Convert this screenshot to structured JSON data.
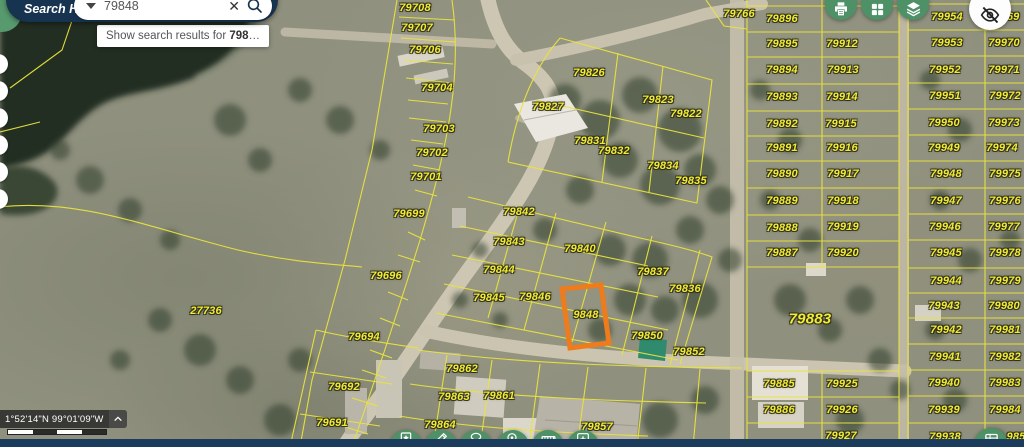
{
  "search": {
    "label": "Search Here:",
    "value": "79848",
    "tooltip_prefix": "Show search results for ",
    "tooltip_query": "798",
    "tooltip_suffix": "…"
  },
  "status": {
    "coordinates": "1°52'14\"N 99°01'09\"W"
  },
  "icons": {
    "clear_glyph": "✕",
    "top_toolbar": [
      "print-icon",
      "apps-grid-icon",
      "layers-icon",
      "visibility-off-icon"
    ],
    "bottom_toolbar": [
      "bookmark-star-icon",
      "pencil-icon",
      "lasso-tool-icon",
      "search-location-icon",
      "measure-icon",
      "add-icon"
    ],
    "bottom_right": "attribute-table-icon"
  },
  "colors": {
    "accent_green": "#4f9166",
    "navy": "#16334f",
    "parcel_line": "#e9e43c",
    "label_yellow": "#f2ec33",
    "selection_orange": "#ee7b1c"
  },
  "map": {
    "selected_parcel_label": "9848",
    "parcels": [
      {
        "t": "79708",
        "x": 415,
        "y": 8
      },
      {
        "t": "79707",
        "x": 417,
        "y": 28
      },
      {
        "t": "79706",
        "x": 425,
        "y": 50
      },
      {
        "t": "79704",
        "x": 437,
        "y": 88
      },
      {
        "t": "79703",
        "x": 439,
        "y": 129
      },
      {
        "t": "79702",
        "x": 432,
        "y": 153
      },
      {
        "t": "79701",
        "x": 426,
        "y": 177
      },
      {
        "t": "79699",
        "x": 409,
        "y": 214
      },
      {
        "t": "79696",
        "x": 386,
        "y": 276
      },
      {
        "t": "27736",
        "x": 206,
        "y": 311
      },
      {
        "t": "79694",
        "x": 364,
        "y": 337
      },
      {
        "t": "79692",
        "x": 344,
        "y": 387
      },
      {
        "t": "79691",
        "x": 332,
        "y": 423
      },
      {
        "t": "79826",
        "x": 589,
        "y": 73
      },
      {
        "t": "79827",
        "x": 548,
        "y": 107
      },
      {
        "t": "79823",
        "x": 658,
        "y": 100
      },
      {
        "t": "79822",
        "x": 686,
        "y": 114
      },
      {
        "t": "79831",
        "x": 590,
        "y": 141
      },
      {
        "t": "79832",
        "x": 614,
        "y": 151
      },
      {
        "t": "79834",
        "x": 663,
        "y": 166
      },
      {
        "t": "79835",
        "x": 691,
        "y": 181
      },
      {
        "t": "79842",
        "x": 519,
        "y": 212
      },
      {
        "t": "79843",
        "x": 509,
        "y": 242
      },
      {
        "t": "79844",
        "x": 499,
        "y": 270
      },
      {
        "t": "79845",
        "x": 489,
        "y": 298
      },
      {
        "t": "79846",
        "x": 535,
        "y": 297
      },
      {
        "t": "79840",
        "x": 580,
        "y": 249
      },
      {
        "t": "79837",
        "x": 653,
        "y": 272
      },
      {
        "t": "79836",
        "x": 685,
        "y": 289
      },
      {
        "t": "9848",
        "x": 586,
        "y": 315
      },
      {
        "t": "79850",
        "x": 647,
        "y": 336
      },
      {
        "t": "79852",
        "x": 689,
        "y": 352
      },
      {
        "t": "79862",
        "x": 462,
        "y": 369
      },
      {
        "t": "79863",
        "x": 454,
        "y": 397
      },
      {
        "t": "79861",
        "x": 499,
        "y": 396
      },
      {
        "t": "79864",
        "x": 440,
        "y": 425
      },
      {
        "t": "79857",
        "x": 597,
        "y": 427
      },
      {
        "t": "79766",
        "x": 739,
        "y": 14
      },
      {
        "t": "79896",
        "x": 782,
        "y": 19
      },
      {
        "t": "79895",
        "x": 782,
        "y": 44
      },
      {
        "t": "79894",
        "x": 782,
        "y": 70
      },
      {
        "t": "79893",
        "x": 782,
        "y": 97
      },
      {
        "t": "79892",
        "x": 782,
        "y": 124
      },
      {
        "t": "79891",
        "x": 782,
        "y": 148
      },
      {
        "t": "79890",
        "x": 782,
        "y": 174
      },
      {
        "t": "79889",
        "x": 782,
        "y": 201
      },
      {
        "t": "79888",
        "x": 782,
        "y": 228
      },
      {
        "t": "79887",
        "x": 782,
        "y": 253
      },
      {
        "t": "79883",
        "x": 810,
        "y": 319,
        "big": true
      },
      {
        "t": "79885",
        "x": 779,
        "y": 384
      },
      {
        "t": "79886",
        "x": 779,
        "y": 410
      },
      {
        "t": "79912",
        "x": 842,
        "y": 44
      },
      {
        "t": "79913",
        "x": 843,
        "y": 70
      },
      {
        "t": "79914",
        "x": 842,
        "y": 97
      },
      {
        "t": "79915",
        "x": 841,
        "y": 124
      },
      {
        "t": "79916",
        "x": 842,
        "y": 148
      },
      {
        "t": "79917",
        "x": 843,
        "y": 174
      },
      {
        "t": "79918",
        "x": 843,
        "y": 201
      },
      {
        "t": "79919",
        "x": 843,
        "y": 227
      },
      {
        "t": "79920",
        "x": 843,
        "y": 253
      },
      {
        "t": "79925",
        "x": 842,
        "y": 384
      },
      {
        "t": "79926",
        "x": 842,
        "y": 410
      },
      {
        "t": "79927",
        "x": 841,
        "y": 436
      },
      {
        "t": "79954",
        "x": 947,
        "y": 17
      },
      {
        "t": "79953",
        "x": 947,
        "y": 43
      },
      {
        "t": "79952",
        "x": 945,
        "y": 70
      },
      {
        "t": "79951",
        "x": 945,
        "y": 96
      },
      {
        "t": "79950",
        "x": 944,
        "y": 123
      },
      {
        "t": "79949",
        "x": 944,
        "y": 148
      },
      {
        "t": "79948",
        "x": 946,
        "y": 174
      },
      {
        "t": "79947",
        "x": 946,
        "y": 201
      },
      {
        "t": "79946",
        "x": 945,
        "y": 227
      },
      {
        "t": "79945",
        "x": 946,
        "y": 253
      },
      {
        "t": "79944",
        "x": 946,
        "y": 281
      },
      {
        "t": "79943",
        "x": 944,
        "y": 306
      },
      {
        "t": "79942",
        "x": 946,
        "y": 330
      },
      {
        "t": "79941",
        "x": 945,
        "y": 357
      },
      {
        "t": "79940",
        "x": 944,
        "y": 383
      },
      {
        "t": "79939",
        "x": 944,
        "y": 410
      },
      {
        "t": "79938",
        "x": 945,
        "y": 437
      },
      {
        "t": "969",
        "x": 1010,
        "y": 17
      },
      {
        "t": "79970",
        "x": 1004,
        "y": 43
      },
      {
        "t": "79971",
        "x": 1004,
        "y": 70
      },
      {
        "t": "79972",
        "x": 1005,
        "y": 96
      },
      {
        "t": "79973",
        "x": 1004,
        "y": 123
      },
      {
        "t": "79974",
        "x": 1002,
        "y": 148
      },
      {
        "t": "79975",
        "x": 1005,
        "y": 174
      },
      {
        "t": "79976",
        "x": 1005,
        "y": 201
      },
      {
        "t": "79977",
        "x": 1004,
        "y": 227
      },
      {
        "t": "79978",
        "x": 1005,
        "y": 253
      },
      {
        "t": "79979",
        "x": 1005,
        "y": 281
      },
      {
        "t": "79980",
        "x": 1004,
        "y": 306
      },
      {
        "t": "79981",
        "x": 1005,
        "y": 330
      },
      {
        "t": "79982",
        "x": 1005,
        "y": 357
      },
      {
        "t": "79983",
        "x": 1005,
        "y": 383
      },
      {
        "t": "79984",
        "x": 1005,
        "y": 410
      },
      {
        "t": "985",
        "x": 1016,
        "y": 437
      }
    ]
  }
}
